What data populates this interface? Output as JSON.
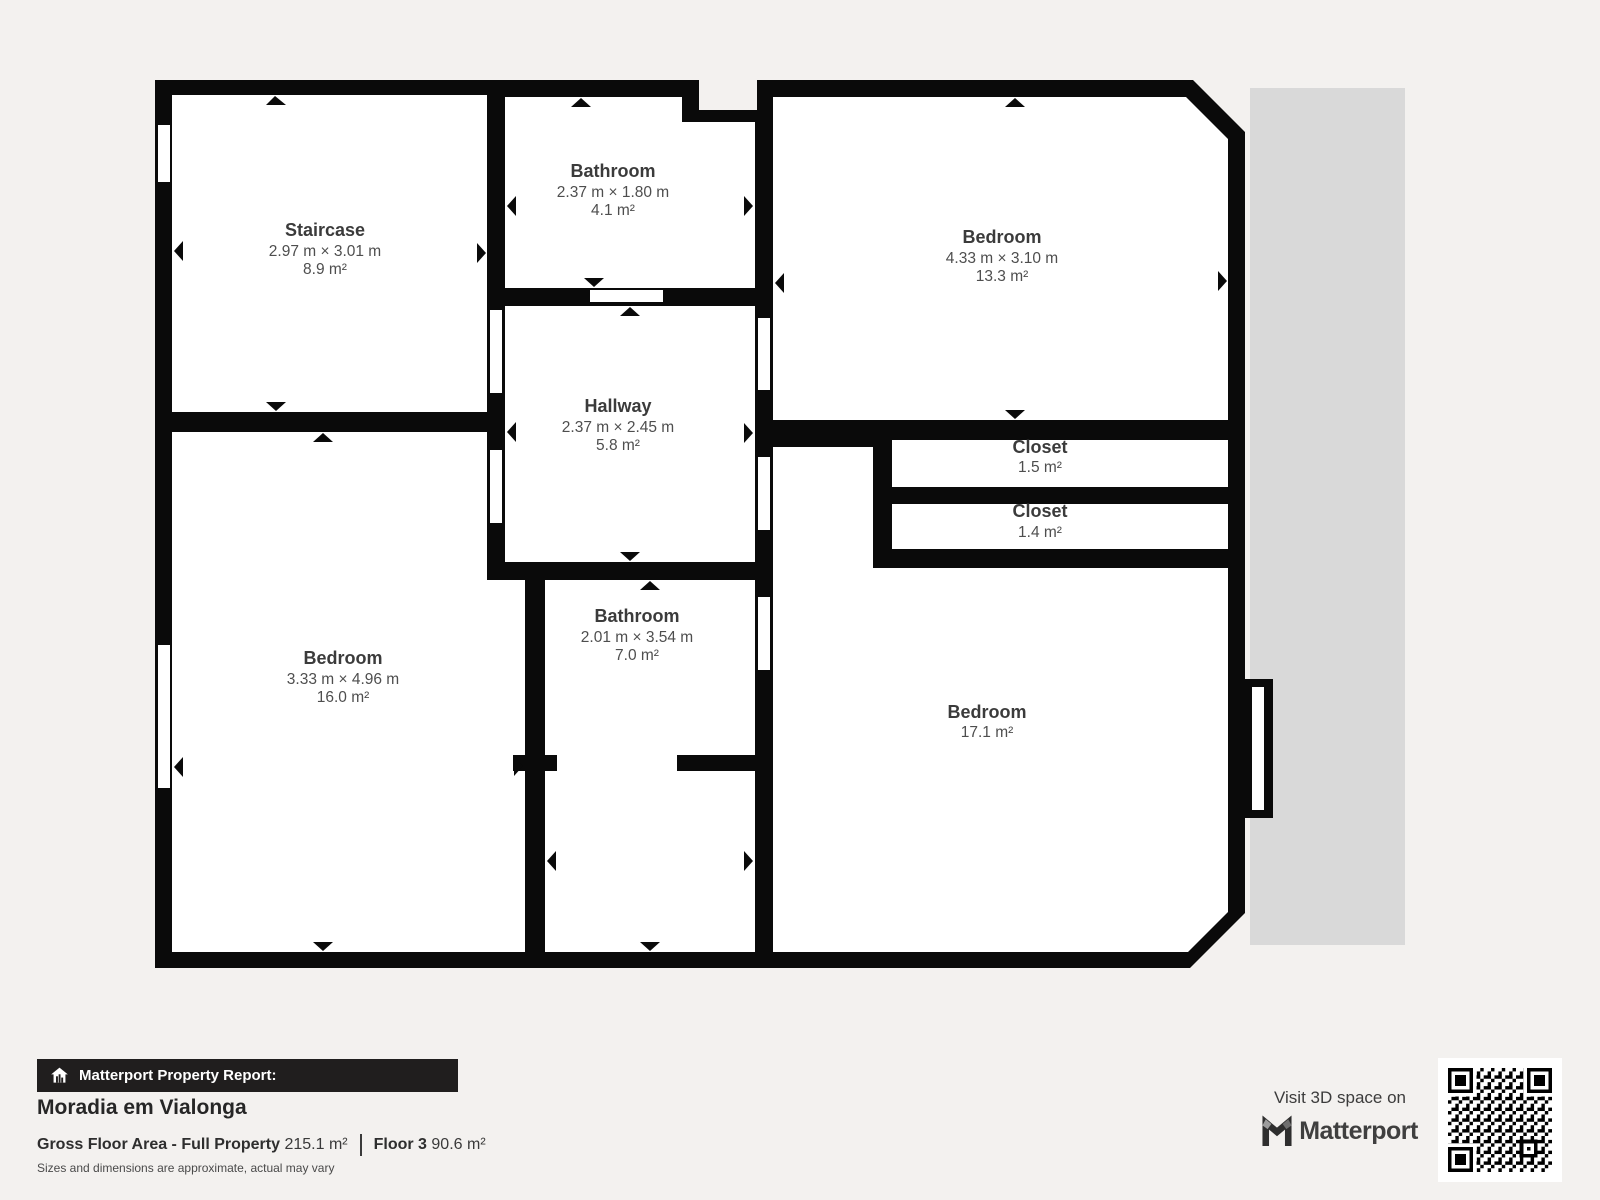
{
  "page": {
    "background": "#f3f1ef"
  },
  "floorplan": {
    "shadow_color": "#d9d9d9",
    "wall_color": "#0a0a0a",
    "room_fill": "#ffffff",
    "rooms": [
      {
        "id": "staircase",
        "name": "Staircase",
        "dims": "2.97 m × 3.01 m",
        "area": "8.9 m²"
      },
      {
        "id": "bathroom-top",
        "name": "Bathroom",
        "dims": "2.37 m × 1.80 m",
        "area": "4.1 m²"
      },
      {
        "id": "bedroom-top-right",
        "name": "Bedroom",
        "dims": "4.33 m × 3.10 m",
        "area": "13.3 m²"
      },
      {
        "id": "hallway",
        "name": "Hallway",
        "dims": "2.37 m × 2.45 m",
        "area": "5.8 m²"
      },
      {
        "id": "closet-upper",
        "name": "Closet",
        "area": "1.5 m²"
      },
      {
        "id": "closet-lower",
        "name": "Closet",
        "area": "1.4 m²"
      },
      {
        "id": "bedroom-bottom-left",
        "name": "Bedroom",
        "dims": "3.33 m × 4.96 m",
        "area": "16.0 m²"
      },
      {
        "id": "bathroom-bottom",
        "name": "Bathroom",
        "dims": "2.01 m × 3.54 m",
        "area": "7.0 m²"
      },
      {
        "id": "bedroom-bottom-right",
        "name": "Bedroom",
        "area": "17.1 m²"
      }
    ]
  },
  "footer": {
    "report_label": "Matterport Property Report:",
    "property_name": "Moradia em Vialonga",
    "gross_floor_area_label": "Gross Floor Area - Full Property",
    "gross_floor_area_value": "215.1 m²",
    "floor_label": "Floor 3",
    "floor_value": "90.6 m²",
    "disclaimer": "Sizes and dimensions are approximate, actual may vary",
    "visit_text": "Visit 3D space on",
    "brand_name": "Matterport",
    "icons": {
      "banner": "house-report-icon",
      "brand": "matterport-m-icon",
      "qr": "qr-code"
    }
  }
}
